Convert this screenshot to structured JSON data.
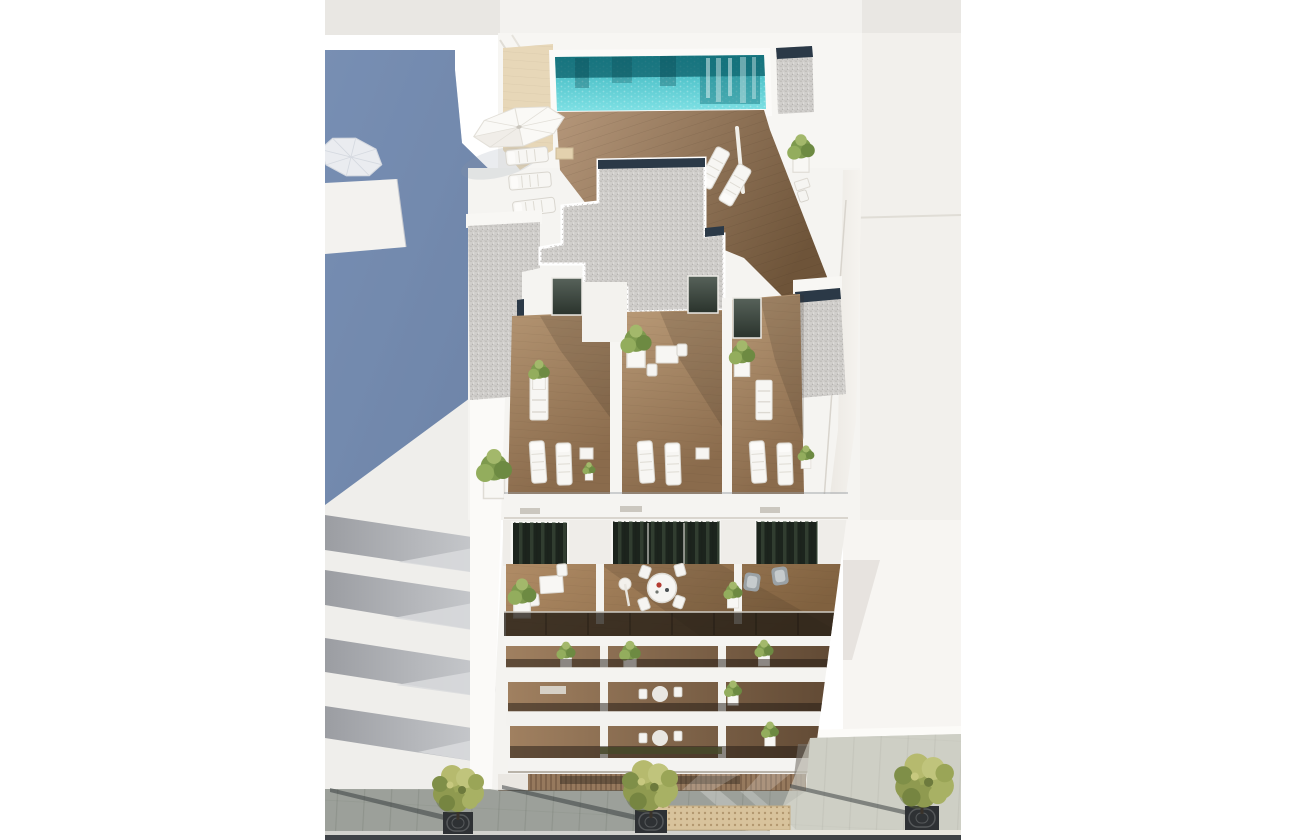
{
  "image": {
    "kind": "3d-architectural-render",
    "view": "aerial-top-down",
    "subject": "new-build apartment block with rooftop infinity pool, private solarium terraces, stacked balconies and street-level sidewalk with trees"
  },
  "colors": {
    "page_background": "#ffffff",
    "sky_band": "#e9e7e3",
    "sky_band_center": "#f3f2ef",
    "building_white": "#f5f4f1",
    "facade_white": "#f4f3f0",
    "wall_shade": "#e4e1db",
    "left_wall_sunlit": "#fbfaf8",
    "shadow_wall_blue": "#7389ad",
    "neighbor_right_wall": "#f2f0ec",
    "neighbor_base_strip": "#fcfbf8",
    "pool_light": "#7edfe3",
    "pool_mid": "#2ba8b2",
    "pool_dark": "#0c5f6a",
    "pool_coping": "#fbfaf8",
    "deck_beige": "#e7d7b8",
    "gravel": "#d0cecb",
    "skylight_navy": "#2b3947",
    "glass_dark": "#241d16",
    "door_glass_green": "#2c352c",
    "balcony_gray_band": "#a8aaae",
    "pavement": "#b5b8b0",
    "pavement_shadow": "#5e6662",
    "tactile_tan": "#d8c39c",
    "curb": "#d2d2cd",
    "road": "#3f4347",
    "garage_wood": "#96795d",
    "furniture_white": "#f7f6f3",
    "armchair_gray": "#9ba2a6",
    "plant_green": "#7e9a4e",
    "tree_green": "#9aa557",
    "tree_grate": "#2e3134"
  },
  "scene": {
    "areas": [
      "rooftop-pool-terrace",
      "solarium-level-terraces",
      "communal-roof-deck",
      "stacked-balcony-floors",
      "ground-floor-entrance",
      "street-sidewalk",
      "left-neighbor-building-in-shadow",
      "right-neighbor-building"
    ],
    "counts": {
      "street_trees": 3,
      "parasols": 4,
      "sun_loungers": 11,
      "visible_balcony_rows": 4,
      "swimming_pools": 1
    }
  }
}
